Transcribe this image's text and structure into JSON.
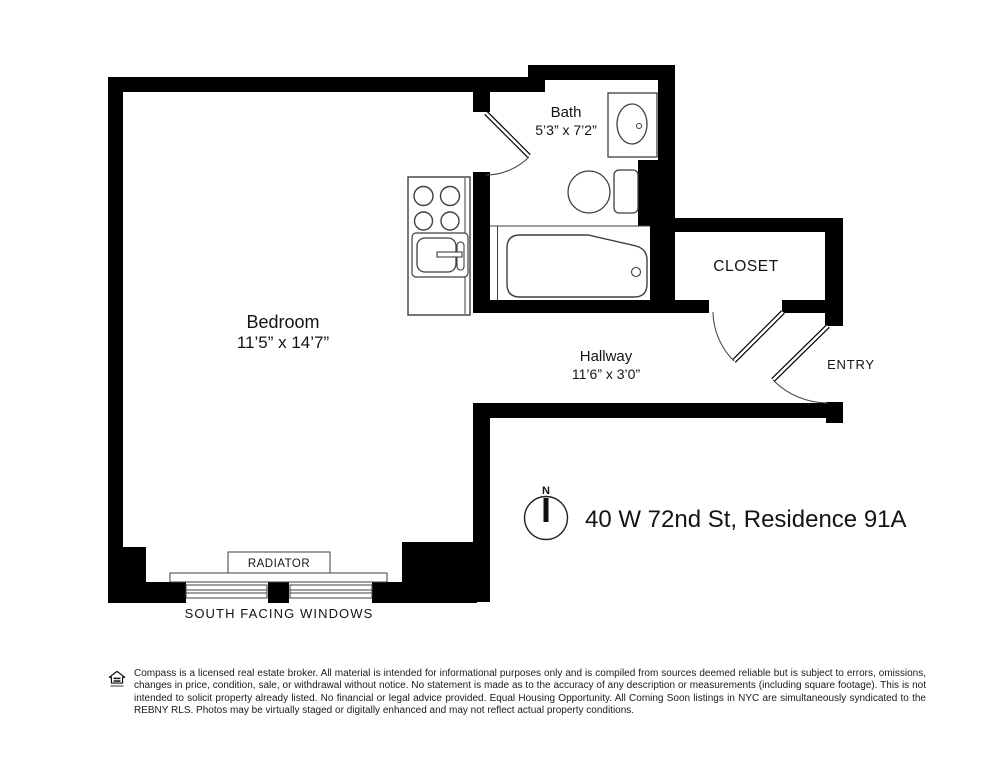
{
  "plan": {
    "address": "40 W 72nd St, Residence 91A",
    "compass": {
      "north": "N"
    },
    "rooms": {
      "bedroom": {
        "label": "Bedroom",
        "dims": "11’5” x 14’7”"
      },
      "bath": {
        "label": "Bath",
        "dims": "5’3” x 7’2”"
      },
      "hallway": {
        "label": "Hallway",
        "dims": "11’6” x 3’0”"
      },
      "closet": {
        "label": "CLOSET"
      },
      "entry": {
        "label": "ENTRY"
      }
    },
    "annotations": {
      "radiator": "RADIATOR",
      "windows": "SOUTH FACING WINDOWS"
    },
    "colors": {
      "wall": "#000000",
      "fixture_line": "#3f3f3f",
      "background": "#ffffff"
    }
  },
  "footer": {
    "disclaimer": "Compass is a licensed real estate broker. All material is intended for informational purposes only and is compiled from sources deemed reliable but is subject to errors, omissions, changes in price, condition, sale, or withdrawal without notice. No statement is made as to the accuracy of any description or measurements (including square footage). This is not intended to solicit property already listed. No financial or legal advice provided. Equal Housing Opportunity. All Coming Soon listings in NYC are simultaneously syndicated to the REBNY RLS. Photos may be virtually staged or digitally enhanced and may not reflect actual property conditions."
  }
}
